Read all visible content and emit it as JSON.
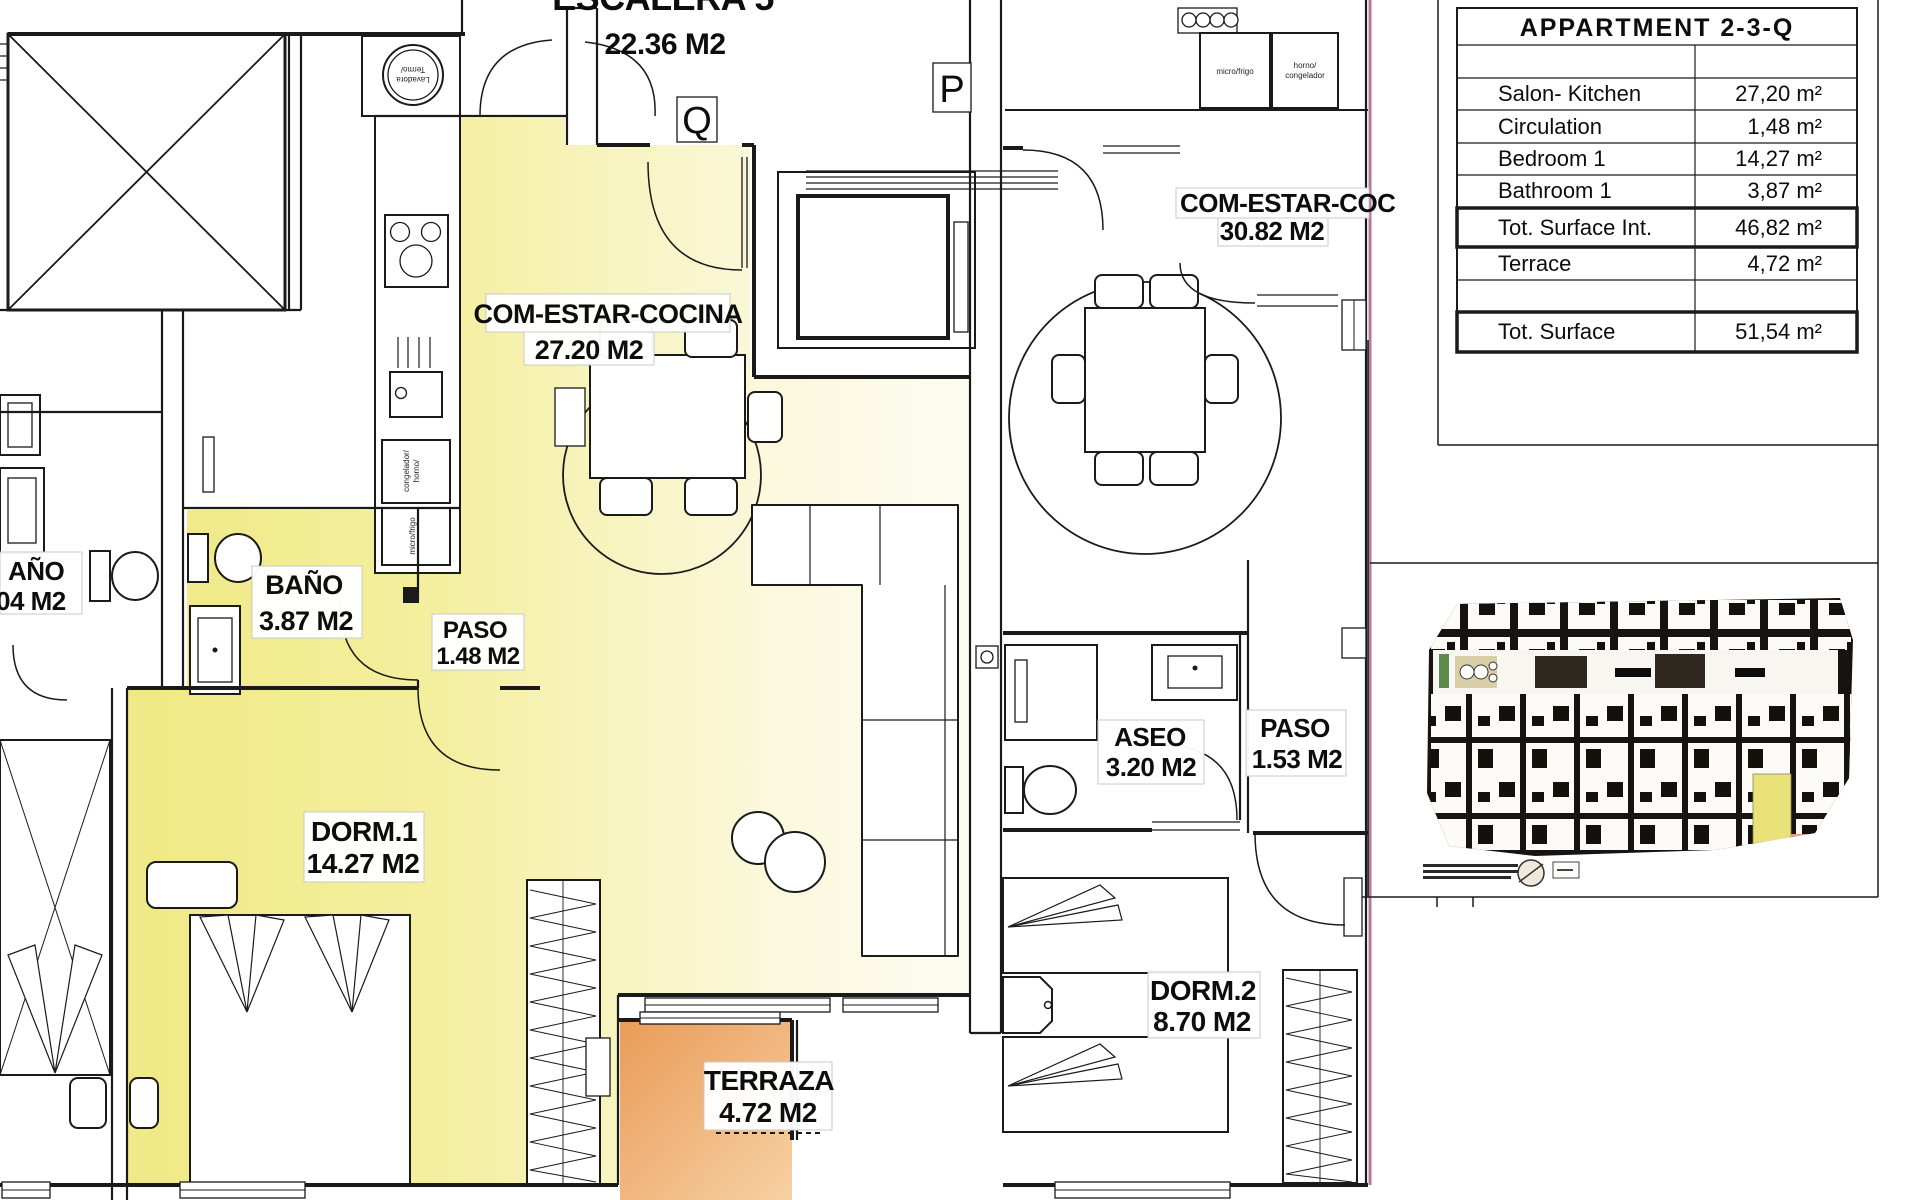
{
  "table": {
    "title": "APPARTMENT 2-3-Q",
    "rows": [
      {
        "label": "Salon- Kitchen",
        "value": "27,20 m²"
      },
      {
        "label": "Circulation",
        "value": "1,48 m²"
      },
      {
        "label": "Bedroom 1",
        "value": "14,27 m²"
      },
      {
        "label": "Bathroom 1",
        "value": "3,87 m²"
      },
      {
        "label": "Tot. Surface Int.",
        "value": "46,82 m²"
      },
      {
        "label": "Terrace",
        "value": "4,72 m²"
      },
      {
        "label": "Tot. Surface",
        "value": "51,54 m²"
      }
    ]
  },
  "markers": {
    "q": "Q",
    "p": "P"
  },
  "rooms": {
    "escalera": {
      "name": "ESCALERA 5",
      "area": "22.36 M2"
    },
    "salon_q": {
      "name": "COM-ESTAR-COCINA",
      "area": "27.20 M2"
    },
    "salon_p": {
      "name": "COM-ESTAR-COC",
      "area": "30.82 M2"
    },
    "bano": {
      "name": "BAÑO",
      "area": "3.87 M2"
    },
    "paso_q": {
      "name": "PASO",
      "area": "1.48 M2"
    },
    "dorm1": {
      "name": "DORM.1",
      "area": "14.27 M2"
    },
    "terraza": {
      "name": "TERRAZA",
      "area": "4.72 M2"
    },
    "aseo": {
      "name": "ASEO",
      "area": "3.20 M2"
    },
    "paso_p": {
      "name": "PASO",
      "area": "1.53 M2"
    },
    "dorm2": {
      "name": "DORM.2",
      "area": "8.70 M2"
    },
    "bano_adj": {
      "name": "AÑO",
      "area": "04 M2"
    }
  },
  "appliances": {
    "lavadora_1": "Lavadora",
    "lavadora_2": "Termo/",
    "congelador_1": "congelador/",
    "congelador_2": "horno/",
    "micro": "micro/frigo",
    "micro_p": "micro/frigo",
    "horno_p_1": "horno/",
    "horno_p_2": "congelador"
  },
  "colors": {
    "highlight_yellow": "#f1ea8e",
    "terrace_orange": "#eb9f5b",
    "plan_edge_pink": "#b5799e"
  }
}
